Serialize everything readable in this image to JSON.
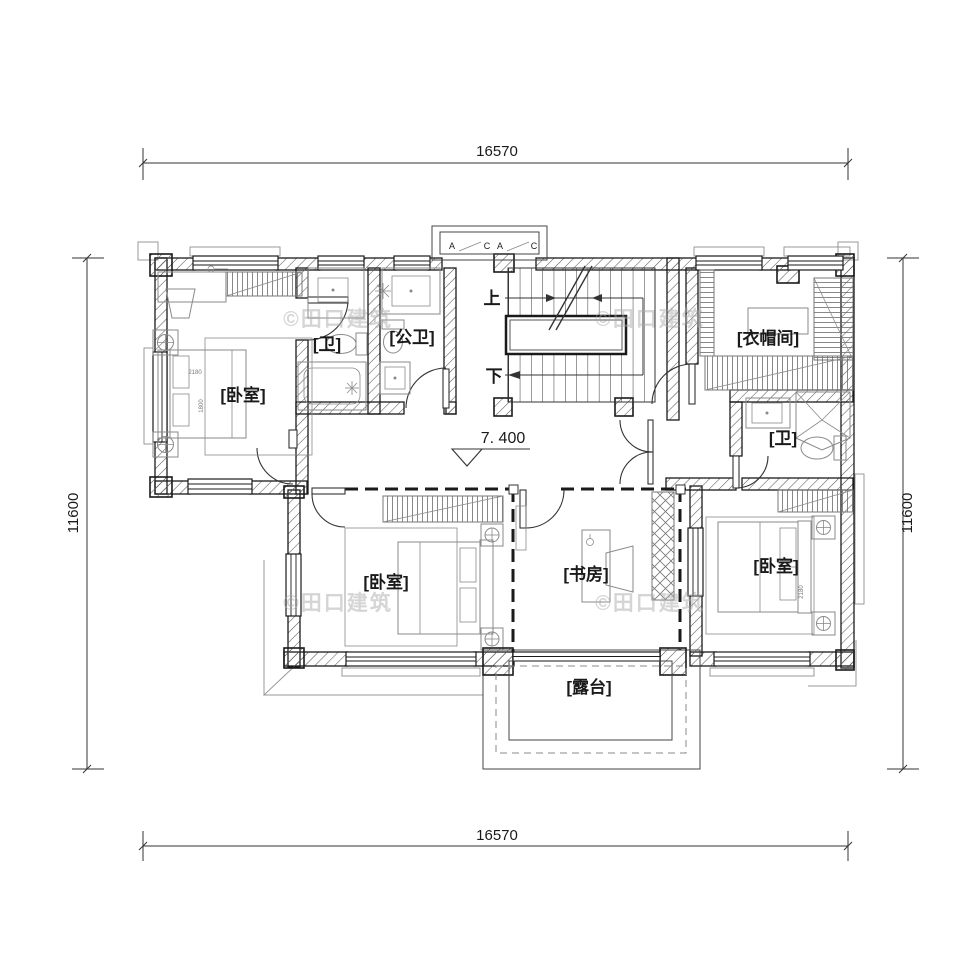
{
  "plan": {
    "dimensions": {
      "top": "16570",
      "bottom": "16570",
      "left": "11600",
      "right": "11600"
    },
    "elevation": "7. 400",
    "stairs": {
      "up": "上",
      "down": "下"
    },
    "bay_window": {
      "a1": "A",
      "c1": "C",
      "a2": "A",
      "c2": "C"
    },
    "rooms": {
      "bedroom_nw": "[卧室]",
      "bath_ensuite": "[卫]",
      "bath_public": "[公卫]",
      "cloakroom": "[衣帽间]",
      "bath_east": "[卫]",
      "bedroom_sw": "[卧室]",
      "study": "[书房]",
      "bedroom_se": "[卧室]",
      "terrace": "[露台]"
    },
    "furniture_dims": {
      "bed_nw_width": "2180",
      "bed_nw_depth": "1800",
      "bed_se_width": "2180"
    },
    "watermark": "©田口建筑"
  }
}
